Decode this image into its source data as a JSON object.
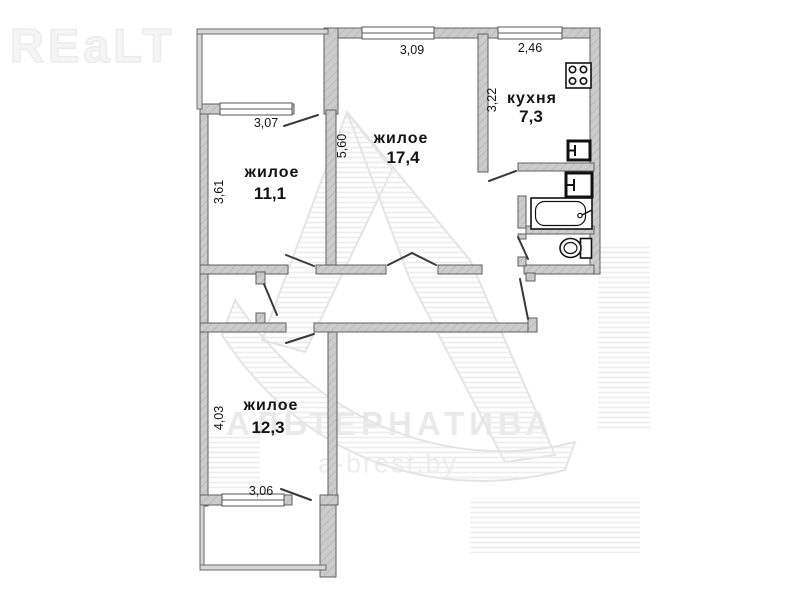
{
  "watermark": {
    "logo": "REaLT",
    "brand": "АЛЬТЕРНАТИВА",
    "site": "a-brest.by"
  },
  "rooms": {
    "living1": {
      "name": "жилое",
      "area": "11,1"
    },
    "living2": {
      "name": "жилое",
      "area": "17,4"
    },
    "kitchen": {
      "name": "кухня",
      "area": "7,3"
    },
    "living3": {
      "name": "жилое",
      "area": "12,3"
    }
  },
  "dims": {
    "living1_width": "3,07",
    "living1_height": "3,61",
    "living2_width": "3,09",
    "living2_height": "5,60",
    "kitchen_width": "2,46",
    "kitchen_height": "3,22",
    "living3_height": "4,03",
    "living3_width": "3,06"
  },
  "icons": {
    "stove": "stove-icon",
    "kitchen_sink": "sink-icon",
    "bath_sink": "sink-icon",
    "bathtub": "bathtub-icon",
    "toilet": "toilet-icon"
  },
  "colors": {
    "wall_fill": "#cccccc",
    "wall_hatch": "#b3b3b3",
    "wall_edge": "#5f5f5f",
    "door_line": "#3a3a3a",
    "fixture_line": "#111111",
    "text": "#141414",
    "watermark": "#ececec"
  }
}
